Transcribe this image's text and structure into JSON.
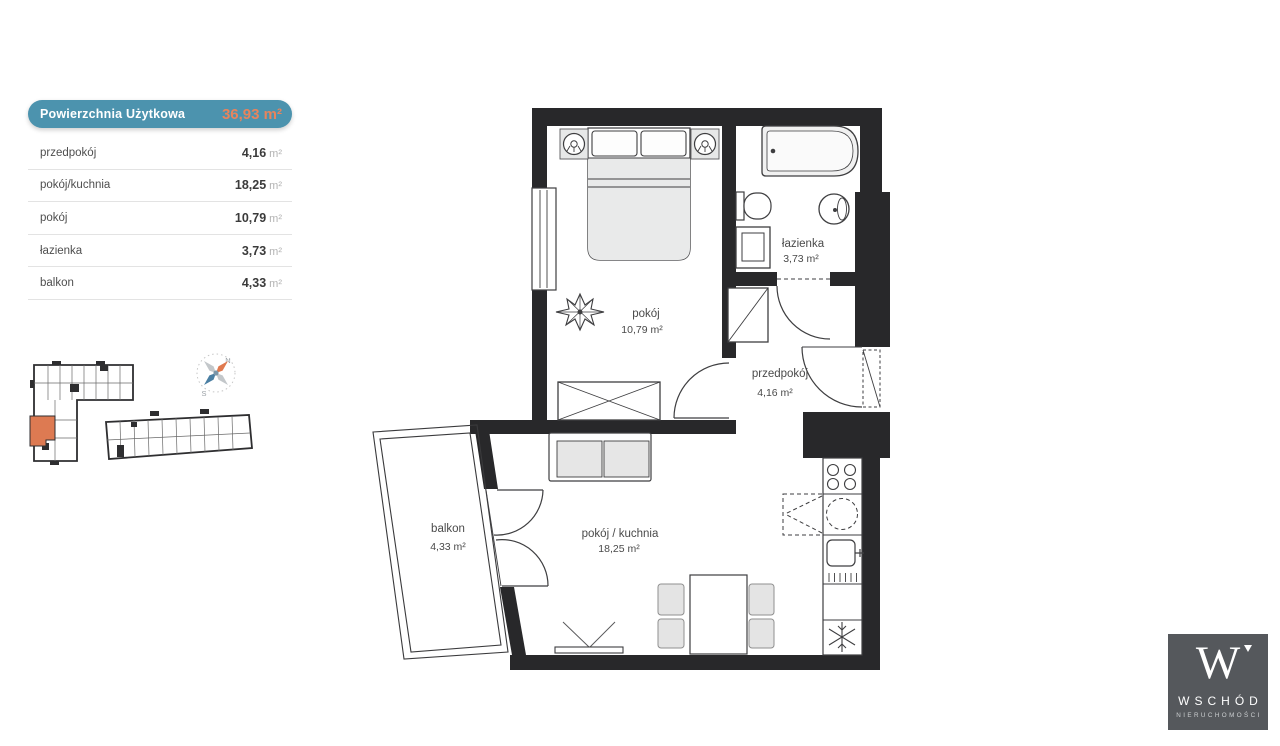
{
  "area_table": {
    "header": {
      "label": "Powierzchnia Użytkowa",
      "value": "36,93",
      "unit": "m²"
    },
    "rows": [
      {
        "label": "przedpokój",
        "value": "4,16",
        "unit": "m²"
      },
      {
        "label": "pokój/kuchnia",
        "value": "18,25",
        "unit": "m²"
      },
      {
        "label": "pokój",
        "value": "10,79",
        "unit": "m²"
      },
      {
        "label": "łazienka",
        "value": "3,73",
        "unit": "m²"
      },
      {
        "label": "balkon",
        "value": "4,33",
        "unit": "m²"
      }
    ]
  },
  "floor_plan": {
    "rooms": [
      {
        "id": "pokoj",
        "name": "pokój",
        "area": "10,79 m²"
      },
      {
        "id": "lazienka",
        "name": "łazienka",
        "area": "3,73 m²"
      },
      {
        "id": "przedpokoj",
        "name": "przedpokój",
        "area": "4,16 m²"
      },
      {
        "id": "pokoj-kuchnia",
        "name": "pokój / kuchnia",
        "area": "18,25 m²"
      },
      {
        "id": "balkon",
        "name": "balkon",
        "area": "4,33 m²"
      }
    ]
  },
  "site_plan": {
    "compass": {
      "north_label": "N",
      "south_label": "S"
    },
    "highlight_color": "#dd7a52"
  },
  "branding": {
    "monogram": "W",
    "company": "WSCHÓD",
    "tagline": "NIERUCHOMOŚCI"
  },
  "colors": {
    "wall": "#28282a",
    "accent_teal": "#4c93ae",
    "accent_orange": "#e8845c",
    "logo_background": "#55585c"
  }
}
